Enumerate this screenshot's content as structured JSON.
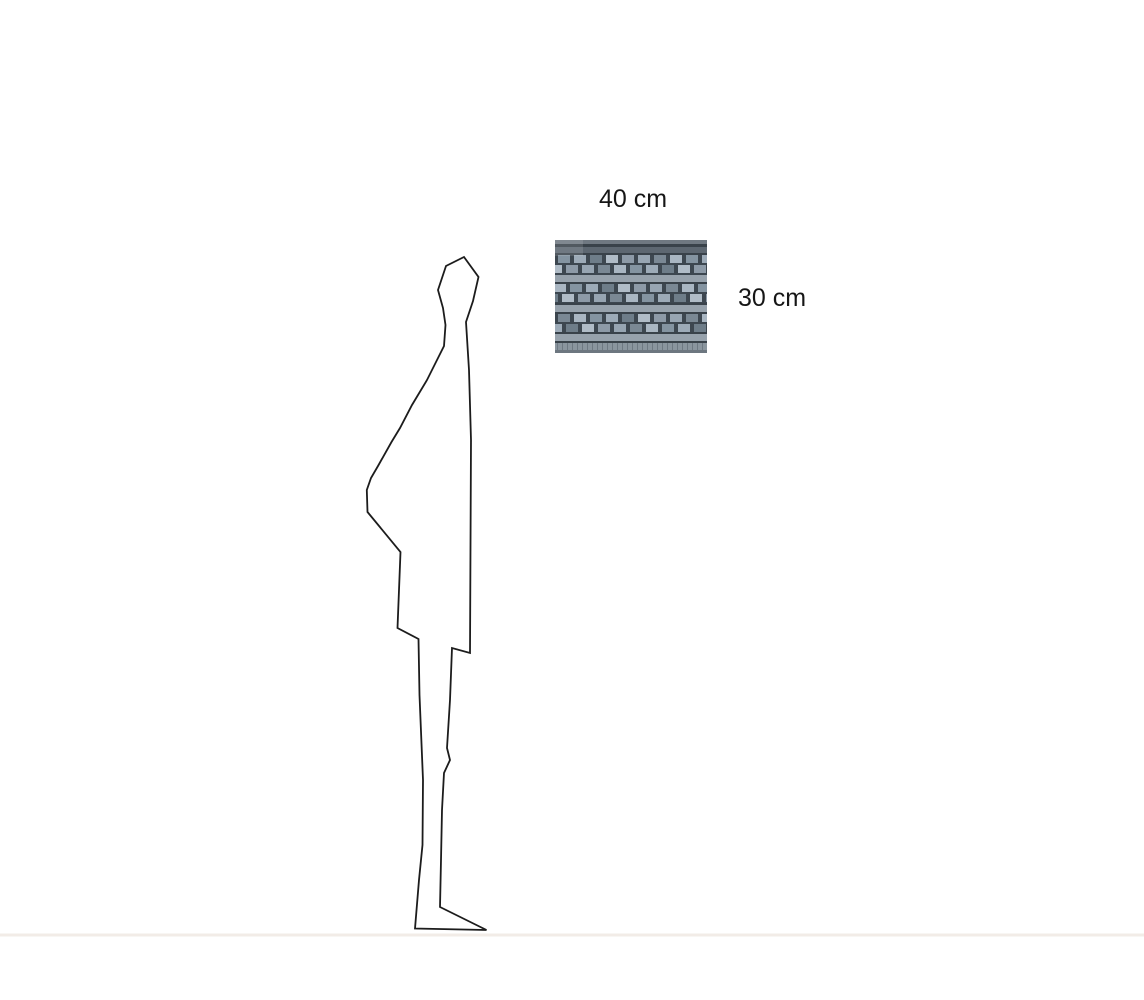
{
  "diagram": {
    "labels": {
      "width": "40 cm",
      "height": "30 cm"
    },
    "colors": {
      "background": "#ffffff",
      "outline": "#1c1c1c",
      "ground_line": "#f2ece7",
      "label_text": "#161616"
    },
    "swatch": {
      "name": "woven-facade-texture",
      "colors": {
        "background": "#3d4750",
        "edge_top": "#6f7881",
        "band_dark": "#39424a",
        "band_mid": "#5d6771",
        "band_light": "#97a2ac",
        "base": "#8a959e",
        "base_edge": "#6d7780",
        "tick": "rgba(40,50,60,0.28)",
        "glare": "rgba(255,255,255,0.12)",
        "window_shades": [
          "#a9b6c2",
          "#8d9aa7",
          "#9dabb8",
          "#7a8894",
          "#b0bcc7",
          "#8494a1",
          "#97a5b2",
          "#6e7d89"
        ]
      }
    }
  }
}
